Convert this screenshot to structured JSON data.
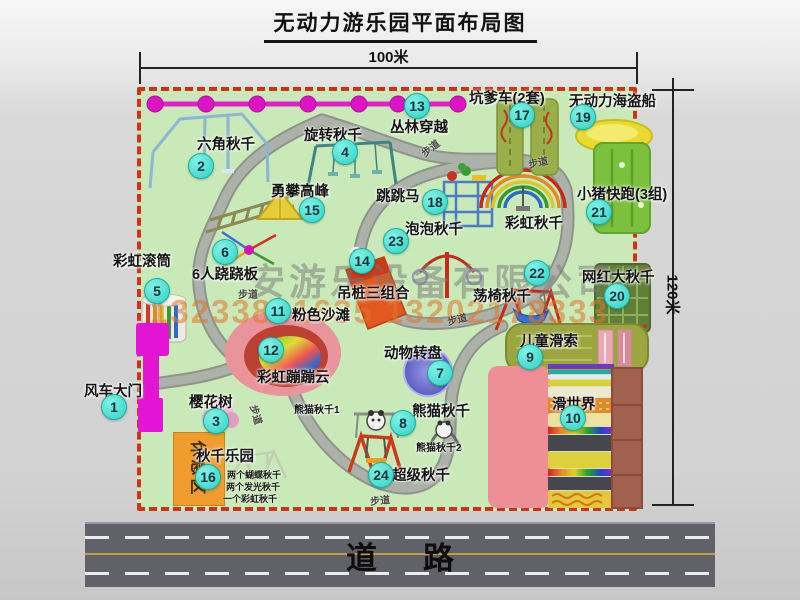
{
  "title": "无动力游乐园平面布局图",
  "dimensions": {
    "width_label": "100米",
    "height_label": "120米"
  },
  "road_label": "道路",
  "trail_label": "步道",
  "rest_area_label": "休息区",
  "watermark": {
    "company": "安游乐设备有限公司",
    "phones": "13233861635 13202178333"
  },
  "attractions": [
    {
      "num": "1",
      "label": "风车大门"
    },
    {
      "num": "2",
      "label": "六角秋千"
    },
    {
      "num": "3",
      "label": "樱花树"
    },
    {
      "num": "4",
      "label": "旋转秋千"
    },
    {
      "num": "5",
      "label": "彩虹滚筒"
    },
    {
      "num": "6",
      "label": "6人跷跷板"
    },
    {
      "num": "7",
      "label": "动物转盘"
    },
    {
      "num": "8",
      "label": "熊猫秋千"
    },
    {
      "num": "9",
      "label": "儿童滑索"
    },
    {
      "num": "10",
      "label": "滑世界"
    },
    {
      "num": "11",
      "label": "粉色沙滩"
    },
    {
      "num": "12",
      "label": "彩虹蹦蹦云"
    },
    {
      "num": "13",
      "label": "丛林穿越"
    },
    {
      "num": "14",
      "label": "吊桩三组合"
    },
    {
      "num": "15",
      "label": "勇攀高峰"
    },
    {
      "num": "16",
      "label": "秋千乐园"
    },
    {
      "num": "17",
      "label": "坑爹车(2套)"
    },
    {
      "num": "18",
      "label": "跳跳马"
    },
    {
      "num": "19",
      "label": "无动力海盗船"
    },
    {
      "num": "20",
      "label": "网红大秋千"
    },
    {
      "num": "21",
      "label": "小猪快跑(3组)"
    },
    {
      "num": "22",
      "label": "荡椅秋千"
    },
    {
      "num": "23",
      "label": "泡泡秋千"
    },
    {
      "num": "24",
      "label": "超级秋千"
    }
  ],
  "extra_labels": {
    "rainbow_swing": "彩虹秋千",
    "panda_swing_1": "熊猫秋千1",
    "panda_swing_2": "熊猫秋千2"
  },
  "legend_notes": [
    "两个蝴蝶秋千",
    "两个发光秋千",
    "一个彩虹秋千"
  ],
  "colors": {
    "park_green": "#c9e9b8",
    "border_red": "#d33117",
    "badge_teal": "#2ed2c4",
    "line_magenta": "#e020c8",
    "rest_orange": "#f09d2e",
    "road_gray": "#61616a"
  }
}
